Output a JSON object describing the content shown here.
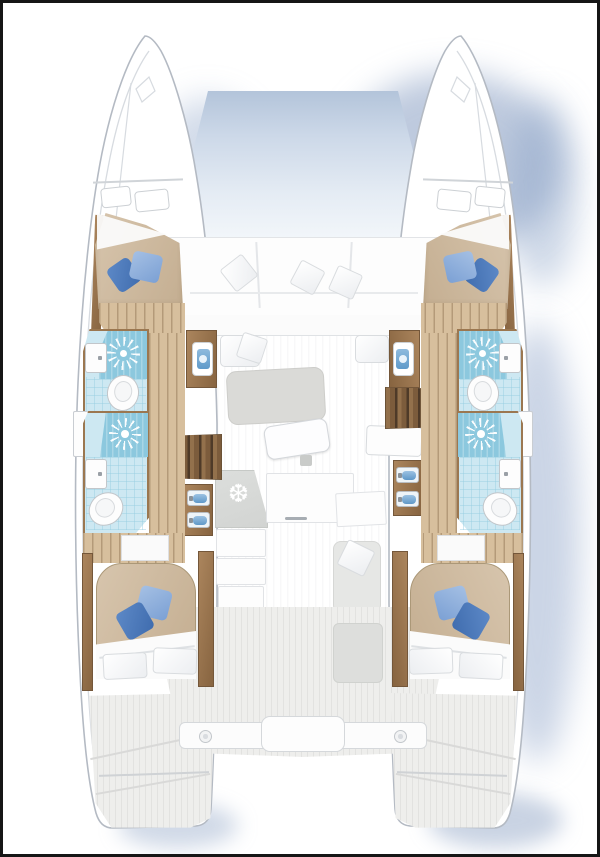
{
  "title": "Catamaran 4-cabin / 4-head interior layout — top view floor plan",
  "icons": {
    "fridge_glyph": "❆",
    "shower_icon": "sunburst",
    "deck_light_icon": "circle"
  },
  "legend": {
    "vessel": "Sailing catamaran floor plan, bows at top, twin stern platforms at bottom",
    "port_hull": [
      "forward-double-cabin",
      "forward-head-with-shower",
      "mid-head-with-shower",
      "aft-double-cabin",
      "aft-deck"
    ],
    "starboard_hull": [
      "forward-double-cabin",
      "forward-head-with-shower",
      "mid-head-with-shower",
      "aft-double-cabin",
      "aft-deck"
    ],
    "center": [
      "bow-trampoline",
      "forward-cockpit-sofa-with-three-pillows",
      "saloon-rug-and-table",
      "chart-desk",
      "galley-counter-with-fridge",
      "companionway-stairs-port-and-starboard",
      "vanity-basins",
      "aft-seat",
      "cockpit-deck",
      "transom-beam-with-two-deck-lights"
    ]
  },
  "colors": {
    "frame": "#161616",
    "hull_fill": "#ffffff",
    "hull_stroke": "#b4bac3",
    "ambient_shadow": "#93aacd",
    "trampoline_top": "#b3c4da",
    "trampoline_bottom": "#f2f6fa",
    "wood_trim": "#9b7750",
    "wood_floor": "#d7bf9d",
    "stair_tread": "#7c5c3c",
    "mattress": "#cdbaa0",
    "pillow_blue_dark": "#3f6cae",
    "pillow_blue_light": "#7ba0d4",
    "cushion_white": "#fdfdfd",
    "head_floor": "#cde8f2",
    "shower_blue": "#8cc8de",
    "sink_basin_blue": "#6fa8d4",
    "rug_gray": "#dadad7",
    "counter_gray": "#d8dad8",
    "deck_gray": "#eeeeec",
    "fixture_white": "#fdfdfd"
  }
}
